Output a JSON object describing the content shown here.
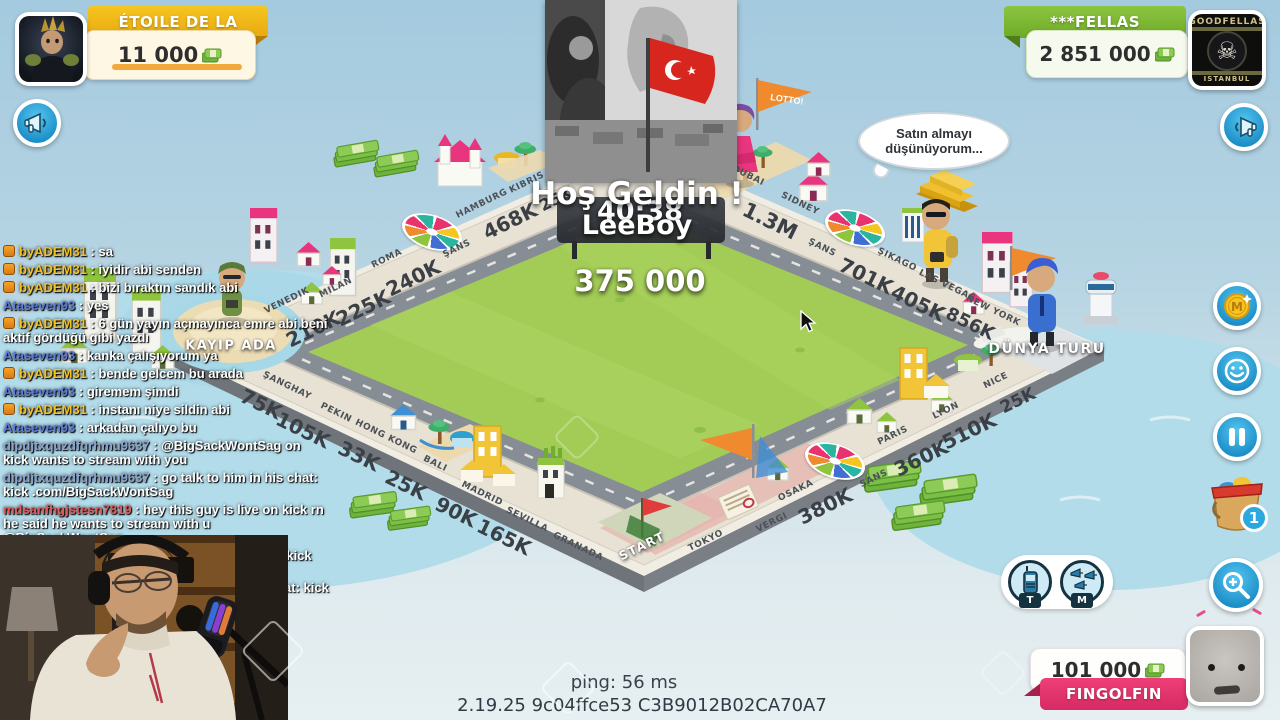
{
  "players": {
    "left": {
      "name": "ÉTOILE DE LA",
      "money": "11 000"
    },
    "right": {
      "name": "***FELLAS",
      "money": "2 851 000",
      "avatar_title": "GOODFELLAS",
      "avatar_subtitle": "ISTANBUL",
      "avatar_icon": "☠"
    },
    "bottom": {
      "name": "FINGOLFIN",
      "money": "101 000"
    }
  },
  "center": {
    "welcome": "Hoş Geldin !",
    "welcome_player": "LeeBoy",
    "timer": "40:38",
    "pot": "375 000"
  },
  "bubble": {
    "text": "Satın almayı düşünüyorum..."
  },
  "board": {
    "corner_left": {
      "label": "KAYIP ADA"
    },
    "corner_right": {
      "label": "DÜNYA TURU"
    },
    "corner_bottom": {
      "label": "START"
    },
    "flag_label": "LOTTO!",
    "top_left_edge": [
      {
        "name": "VENEDIK",
        "price": "210K"
      },
      {
        "name": "MILAN",
        "price": "225K"
      },
      {
        "name": "ROMA",
        "price": "240K"
      },
      {
        "name": "ŞANS",
        "price": ""
      },
      {
        "name": "HAMBURG",
        "price": "468K"
      },
      {
        "name": "KIBRIS",
        "price": "25K"
      }
    ],
    "top_right_edge": [
      {
        "name": "DUBAI",
        "price": ""
      },
      {
        "name": "SIDNEY",
        "price": "1.3M"
      },
      {
        "name": "ŞANS",
        "price": ""
      },
      {
        "name": "ŞIKAGO",
        "price": "701K"
      },
      {
        "name": "LAS VEGAS",
        "price": "405K"
      },
      {
        "name": "NEW YORK",
        "price": "856K"
      }
    ],
    "bottom_right_edge": [
      {
        "name": "NICE",
        "price": "25K"
      },
      {
        "name": "LYON",
        "price": "510K"
      },
      {
        "name": "PARIS",
        "price": "360K"
      },
      {
        "name": "ŞANS",
        "price": ""
      },
      {
        "name": "OSAKA",
        "price": "380K"
      },
      {
        "name": "VERGI",
        "price": ""
      },
      {
        "name": "TOKYO",
        "price": ""
      }
    ],
    "bottom_left_edge": [
      {
        "name": "ŞANGHAY",
        "price": "75K"
      },
      {
        "name": "PEKIN",
        "price": "105K"
      },
      {
        "name": "HONG KONG",
        "price": "33K"
      },
      {
        "name": "BALI",
        "price": "25K"
      },
      {
        "name": "MADRID",
        "price": "90K"
      },
      {
        "name": "SEVILLA",
        "price": "165K"
      },
      {
        "name": "GRANADA",
        "price": ""
      }
    ]
  },
  "hud": {
    "coin_label": "M",
    "bucket_badge": "1",
    "talk_label": "T",
    "mega_label": "M",
    "icons": [
      "megaphone",
      "coin",
      "smiley",
      "pause",
      "bucket",
      "zoom-in",
      "walkie-talkie",
      "triple-megaphone"
    ]
  },
  "chat": {
    "messages": [
      {
        "user": "byADEM31",
        "color": "#f3c224",
        "badge": true,
        "text": "sa"
      },
      {
        "user": "byADEM31",
        "color": "#f3c224",
        "badge": true,
        "text": "iyidir abi senden"
      },
      {
        "user": "byADEM31",
        "color": "#f3c224",
        "badge": true,
        "text": "bizi bıraktın sandık abi"
      },
      {
        "user": "Ataseven93",
        "color": "#5b7bd5",
        "badge": false,
        "text": "yes"
      },
      {
        "user": "byADEM31",
        "color": "#f3c224",
        "badge": true,
        "text": "6 gün yayın açmayınca emre abi beni aktif gördüğü gibi yazdı"
      },
      {
        "user": "Ataseven93",
        "color": "#5b7bd5",
        "badge": false,
        "text": "kanka çalışıyorum ya"
      },
      {
        "user": "byADEM31",
        "color": "#f3c224",
        "badge": true,
        "text": "bende gelcem bu arada"
      },
      {
        "user": "Ataseven93",
        "color": "#5b7bd5",
        "badge": false,
        "text": "giremem şimdi"
      },
      {
        "user": "byADEM31",
        "color": "#f3c224",
        "badge": true,
        "text": "instanı niye sildin abi"
      },
      {
        "user": "Ataseven93",
        "color": "#5b7bd5",
        "badge": false,
        "text": "arkadan çalıyo bu"
      },
      {
        "user": "dipdjtxquzdfqrhmu9637",
        "color": "#8aa4cf",
        "badge": false,
        "text": "@BigSackWontSag on kick wants to stream with you"
      },
      {
        "user": "dipdjtxquzdfqrhmu9637",
        "color": "#8aa4cf",
        "badge": false,
        "text": "go talk to him in his chat: kick .com/BigSackWontSag"
      },
      {
        "user": "mdsanfhgjstesn7819",
        "color": "#e25c5c",
        "badge": false,
        "text": "hey this guy is live on kick rn he said he wants to stream with u @BigSackWontSag"
      },
      {
        "user": "mdsanfhgjstesn7819",
        "color": "#e25c5c",
        "badge": false,
        "text": "@BigSackWontSag on kick wants to stream with you"
      },
      {
        "user": "mdsanfhgjstesn7819",
        "color": "#e25c5c",
        "badge": false,
        "text": "go talk to him in his chat: kick .com/BigSackWontSag"
      }
    ]
  },
  "footer": {
    "ping": "ping: 56 ms",
    "version": "2.19.25 9c04ffce53 C3B9012B02CA70A7"
  },
  "colors": {
    "gold_banner": "#f2bc1d",
    "green_banner": "#7cb82f",
    "pink_banner": "#e8336f",
    "hud_blue": "#29a8e0",
    "board_green": "#a3cc57",
    "chat_yellow": "#f3c224",
    "chat_blue": "#5b7bd5",
    "chat_red": "#e25c5c"
  }
}
